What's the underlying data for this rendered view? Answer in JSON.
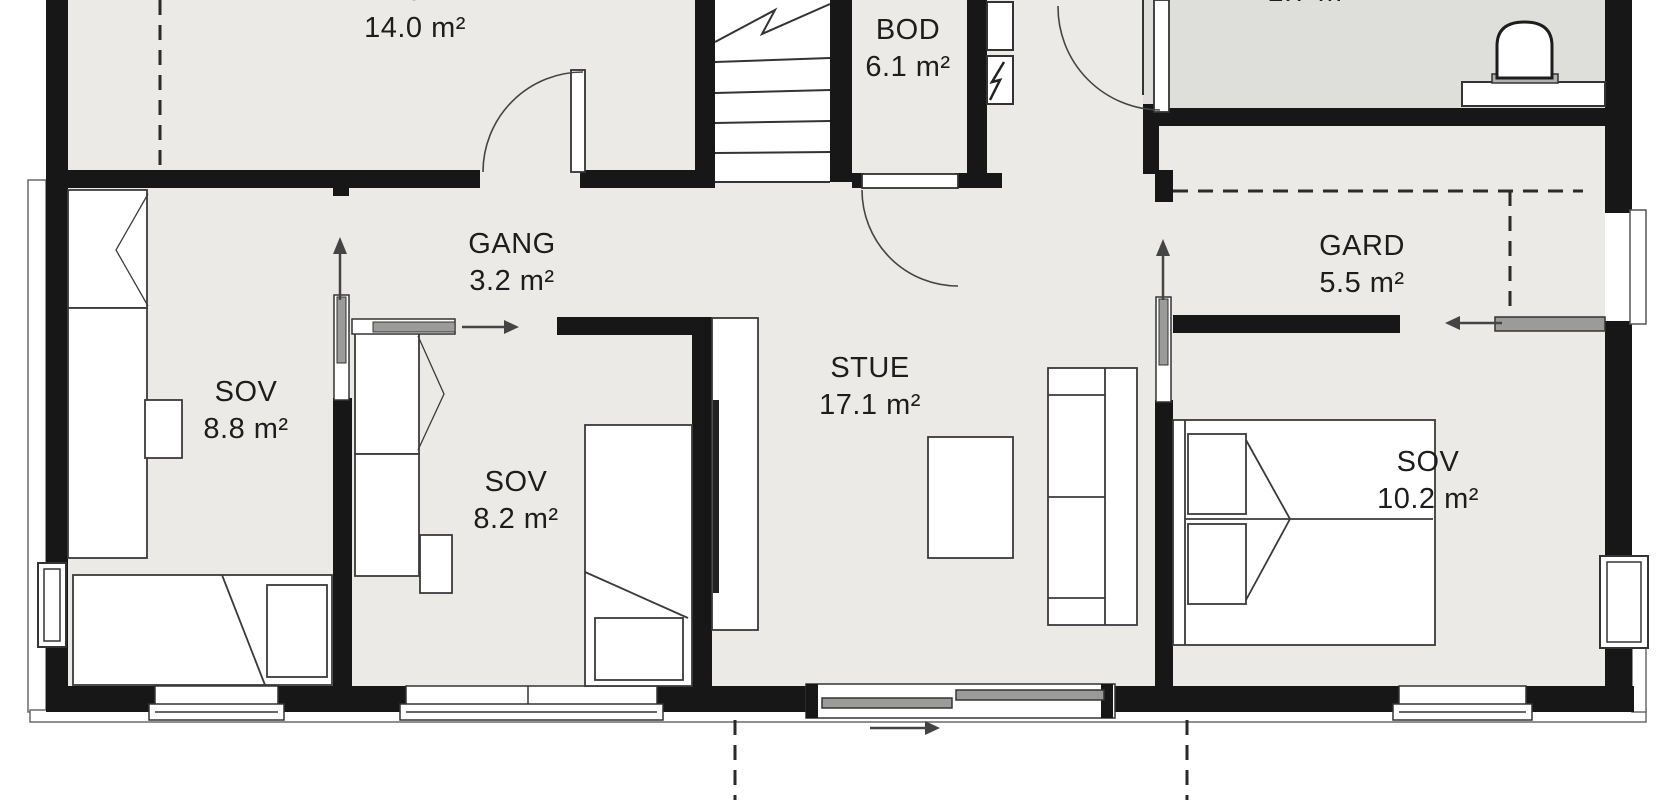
{
  "floorplan": {
    "title": "First floor plan",
    "rooms": [
      {
        "id": "bod-large",
        "label": "BOD",
        "area": "14.0 m²"
      },
      {
        "id": "bod-small",
        "label": "BOD",
        "area": "6.1 m²"
      },
      {
        "id": "wc",
        "label": "",
        "area": "1.7 m²"
      },
      {
        "id": "gang",
        "label": "GANG",
        "area": "3.2 m²"
      },
      {
        "id": "gard",
        "label": "GARD",
        "area": "5.5 m²"
      },
      {
        "id": "sov-1",
        "label": "SOV",
        "area": "8.8 m²"
      },
      {
        "id": "sov-2",
        "label": "SOV",
        "area": "8.2 m²"
      },
      {
        "id": "stue",
        "label": "STUE",
        "area": "17.1 m²"
      },
      {
        "id": "sov-3",
        "label": "SOV",
        "area": "10.2 m²"
      }
    ],
    "icons": [
      "stairs-icon",
      "toilet-icon",
      "electric-panel-icon",
      "door-swing-icon",
      "sliding-door-arrow-icon",
      "entry-direction-arrow-icon"
    ],
    "colors": {
      "wall": "#171717",
      "floor": "#ECEAE6",
      "wet_room_floor": "#DEDEDA",
      "line": "#333333",
      "slider_panel": "#9B9B99",
      "outside": "#FFFFFF"
    }
  }
}
